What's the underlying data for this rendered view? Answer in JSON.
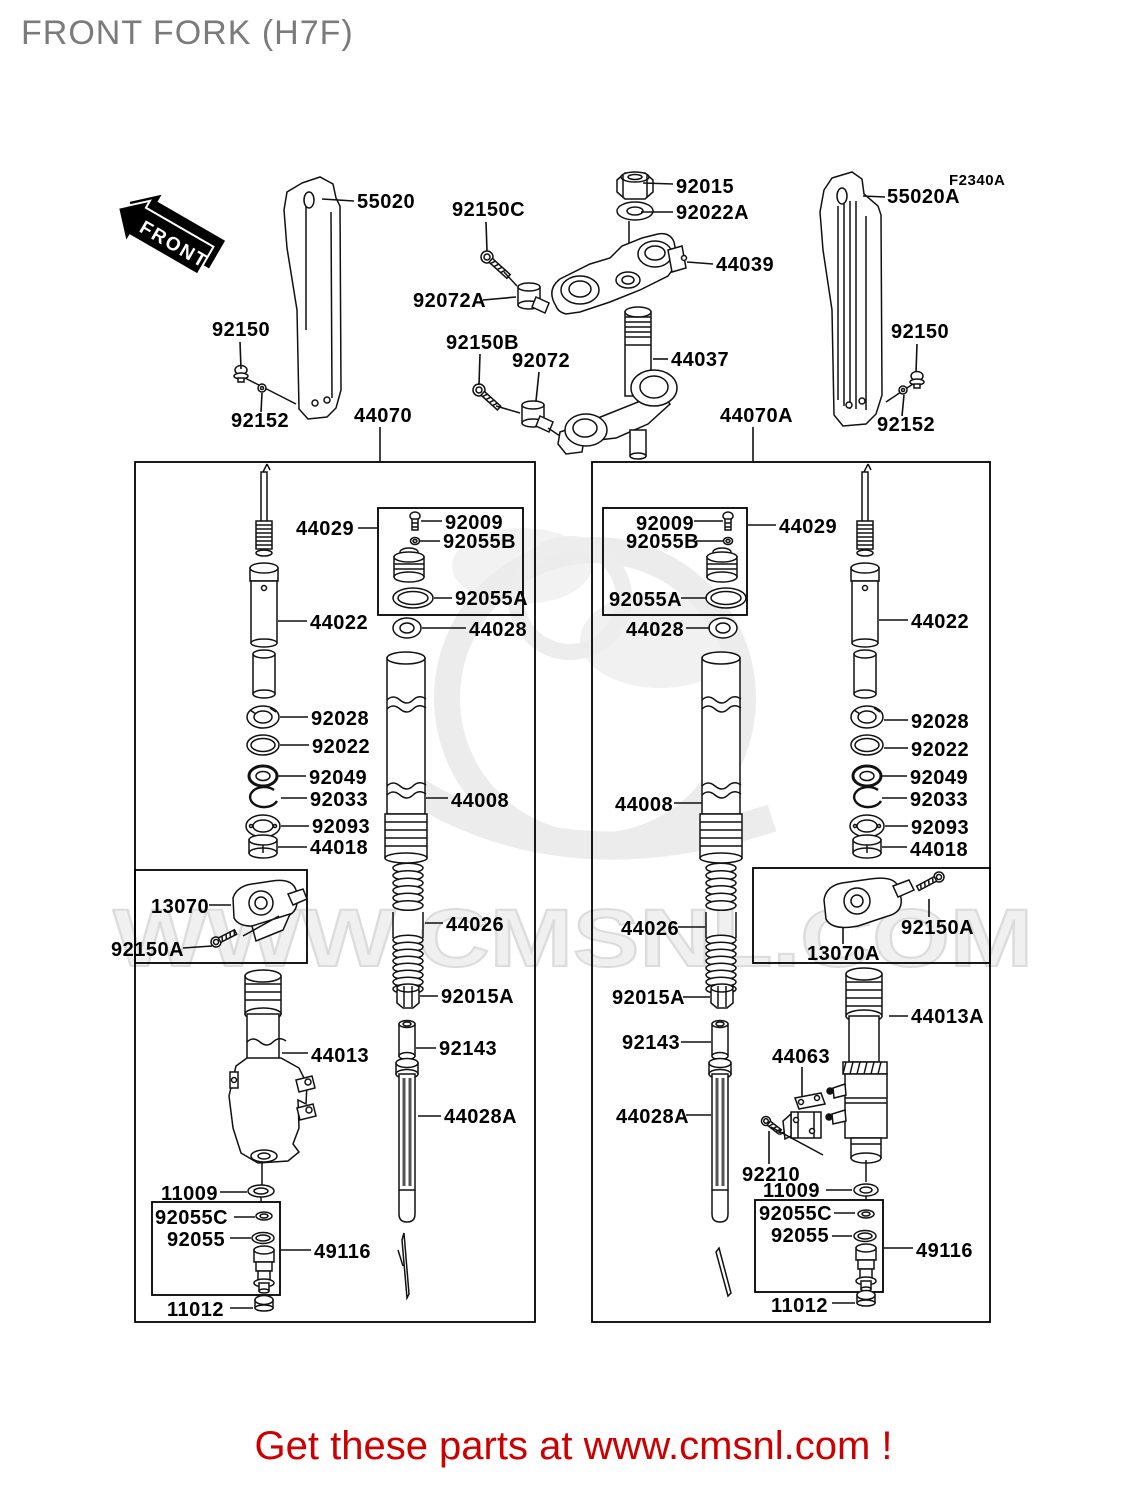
{
  "title": "FRONT FORK (H7F)",
  "diagram_code": "F2340A",
  "front_marker": "FRONT",
  "watermark": {
    "text": "WWW.CMSNL.COM"
  },
  "footer": {
    "text": "Get these parts at www.cmsnl.com !",
    "color": "#cc0000"
  },
  "colors": {
    "line": "#111111",
    "label": "#000000",
    "title": "#7b7b7b",
    "watermark": "#ececec",
    "footer": "#cc0000",
    "background": "#ffffff"
  },
  "boxes": [
    {
      "name": "left-fork-assembly",
      "x": 135,
      "y": 462,
      "w": 400,
      "h": 860
    },
    {
      "name": "right-fork-assembly",
      "x": 592,
      "y": 462,
      "w": 398,
      "h": 860
    },
    {
      "name": "left-adjuster-kit",
      "x": 378,
      "y": 508,
      "w": 145,
      "h": 107
    },
    {
      "name": "right-adjuster-kit",
      "x": 603,
      "y": 508,
      "w": 144,
      "h": 107
    },
    {
      "name": "left-clamp-kit",
      "x": 135,
      "y": 870,
      "w": 172,
      "h": 93
    },
    {
      "name": "right-clamp-kit",
      "x": 753,
      "y": 868,
      "w": 237,
      "h": 95
    },
    {
      "name": "left-valve-kit",
      "x": 152,
      "y": 1202,
      "w": 128,
      "h": 93
    },
    {
      "name": "right-valve-kit",
      "x": 755,
      "y": 1200,
      "w": 128,
      "h": 92
    }
  ],
  "labels": [
    {
      "part": "55020",
      "side": "left",
      "x": 357,
      "y": 208,
      "leader": [
        322,
        199,
        354,
        201
      ]
    },
    {
      "part": "92150C",
      "side": "top",
      "x": 452,
      "y": 216,
      "leader": [
        486,
        222,
        487,
        251
      ]
    },
    {
      "part": "92015",
      "side": "top",
      "x": 676,
      "y": 193,
      "leader": [
        643,
        183,
        673,
        184
      ]
    },
    {
      "part": "92022A",
      "side": "top",
      "x": 676,
      "y": 219,
      "leader": [
        641,
        212,
        673,
        212
      ]
    },
    {
      "part": "44039",
      "side": "top",
      "x": 716,
      "y": 271,
      "leader": [
        687,
        262,
        713,
        264
      ]
    },
    {
      "part": "92072A",
      "side": "top",
      "x": 413,
      "y": 307,
      "leader": [
        483,
        300,
        516,
        297
      ]
    },
    {
      "part": "55020A",
      "side": "right",
      "x": 887,
      "y": 203,
      "leader": [
        863,
        196,
        885,
        197
      ]
    },
    {
      "part": "F2340A",
      "side": "top",
      "x": 949,
      "y": 185,
      "size": "sm",
      "leader": null
    },
    {
      "part": "92150",
      "side": "right",
      "x": 891,
      "y": 338,
      "leader": [
        917,
        344,
        916,
        372
      ]
    },
    {
      "part": "92152",
      "side": "right",
      "x": 877,
      "y": 431,
      "leader": [
        902,
        416,
        904,
        395
      ]
    },
    {
      "part": "92150",
      "side": "left",
      "x": 212,
      "y": 336,
      "leader": [
        240,
        342,
        241,
        369
      ]
    },
    {
      "part": "92152",
      "side": "left",
      "x": 231,
      "y": 427,
      "leader": [
        261,
        412,
        262,
        393
      ]
    },
    {
      "part": "92150B",
      "side": "top",
      "x": 446,
      "y": 349,
      "leader": [
        480,
        354,
        479,
        385
      ]
    },
    {
      "part": "92072",
      "side": "top",
      "x": 512,
      "y": 367,
      "leader": [
        539,
        372,
        536,
        401
      ]
    },
    {
      "part": "44037",
      "side": "top",
      "x": 671,
      "y": 366,
      "leader": [
        653,
        359,
        668,
        359
      ]
    },
    {
      "part": "44070",
      "side": "left",
      "x": 354,
      "y": 422,
      "leader": [
        380,
        427,
        380,
        461
      ]
    },
    {
      "part": "44070A",
      "side": "right",
      "x": 720,
      "y": 422,
      "leader": [
        753,
        427,
        753,
        461
      ]
    },
    {
      "part": "44029",
      "side": "left",
      "x": 296,
      "y": 535,
      "leader": [
        358,
        528,
        377,
        528
      ]
    },
    {
      "part": "92009",
      "side": "left",
      "x": 445,
      "y": 529,
      "leader": [
        421,
        521,
        442,
        521
      ]
    },
    {
      "part": "92055B",
      "side": "left",
      "x": 443,
      "y": 548,
      "leader": [
        419,
        541,
        440,
        541
      ]
    },
    {
      "part": "92055A",
      "side": "left",
      "x": 455,
      "y": 605,
      "leader": [
        434,
        598,
        452,
        598
      ]
    },
    {
      "part": "44022",
      "side": "left",
      "x": 310,
      "y": 629,
      "leader": [
        278,
        621,
        307,
        621
      ]
    },
    {
      "part": "44028",
      "side": "left",
      "x": 469,
      "y": 636,
      "leader": [
        422,
        628,
        466,
        628
      ]
    },
    {
      "part": "92028",
      "side": "left",
      "x": 311,
      "y": 725,
      "leader": [
        280,
        717,
        308,
        717
      ]
    },
    {
      "part": "92022",
      "side": "left",
      "x": 312,
      "y": 753,
      "leader": [
        280,
        745,
        309,
        745
      ]
    },
    {
      "part": "92049",
      "side": "left",
      "x": 309,
      "y": 784,
      "leader": [
        278,
        776,
        306,
        776
      ]
    },
    {
      "part": "92033",
      "side": "left",
      "x": 310,
      "y": 806,
      "leader": [
        281,
        798,
        307,
        798
      ]
    },
    {
      "part": "92093",
      "side": "left",
      "x": 312,
      "y": 833,
      "leader": [
        281,
        826,
        309,
        826
      ]
    },
    {
      "part": "44018",
      "side": "left",
      "x": 310,
      "y": 854,
      "leader": [
        278,
        847,
        307,
        847
      ]
    },
    {
      "part": "44008",
      "side": "left",
      "x": 451,
      "y": 807,
      "leader": [
        426,
        798,
        448,
        798
      ]
    },
    {
      "part": "13070",
      "side": "left",
      "x": 151,
      "y": 913,
      "leader": [
        209,
        905,
        231,
        905
      ]
    },
    {
      "part": "92150A",
      "side": "left",
      "x": 111,
      "y": 956,
      "leader": [
        183,
        948,
        212,
        946
      ]
    },
    {
      "part": "44013",
      "side": "left",
      "x": 311,
      "y": 1062,
      "leader": [
        282,
        1053,
        308,
        1053
      ]
    },
    {
      "part": "44026",
      "side": "left",
      "x": 446,
      "y": 931,
      "leader": [
        425,
        923,
        443,
        923
      ]
    },
    {
      "part": "92015A",
      "side": "left",
      "x": 441,
      "y": 1003,
      "leader": [
        420,
        996,
        438,
        996
      ]
    },
    {
      "part": "92143",
      "side": "left",
      "x": 439,
      "y": 1055,
      "leader": [
        416,
        1048,
        436,
        1048
      ]
    },
    {
      "part": "44028A",
      "side": "left",
      "x": 444,
      "y": 1123,
      "leader": [
        418,
        1116,
        441,
        1116
      ]
    },
    {
      "part": "11009",
      "side": "left",
      "x": 161,
      "y": 1200,
      "leader": [
        220,
        1192,
        247,
        1192
      ]
    },
    {
      "part": "92055C",
      "side": "left",
      "x": 155,
      "y": 1224,
      "leader": [
        234,
        1217,
        255,
        1217
      ]
    },
    {
      "part": "92055",
      "side": "left",
      "x": 167,
      "y": 1246,
      "leader": [
        230,
        1238,
        251,
        1238
      ]
    },
    {
      "part": "49116",
      "side": "left",
      "x": 314,
      "y": 1258,
      "leader": [
        281,
        1250,
        311,
        1250
      ]
    },
    {
      "part": "11012",
      "side": "left",
      "x": 167,
      "y": 1316,
      "leader": [
        230,
        1308,
        253,
        1308
      ]
    },
    {
      "part": "44029",
      "side": "right",
      "x": 779,
      "y": 533,
      "leader": [
        748,
        525,
        776,
        525
      ]
    },
    {
      "part": "92009",
      "side": "right",
      "x": 636,
      "y": 530,
      "leader": [
        694,
        521,
        723,
        521
      ]
    },
    {
      "part": "92055B",
      "side": "right",
      "x": 626,
      "y": 548,
      "leader": [
        696,
        541,
        724,
        541
      ]
    },
    {
      "part": "92055A",
      "side": "right",
      "x": 609,
      "y": 606,
      "leader": [
        681,
        598,
        707,
        598
      ]
    },
    {
      "part": "44028",
      "side": "right",
      "x": 626,
      "y": 636,
      "leader": [
        686,
        628,
        710,
        628
      ]
    },
    {
      "part": "44022",
      "side": "right",
      "x": 911,
      "y": 628,
      "leader": [
        879,
        620,
        908,
        620
      ]
    },
    {
      "part": "44008",
      "side": "right",
      "x": 615,
      "y": 811,
      "leader": [
        674,
        803,
        702,
        803
      ]
    },
    {
      "part": "92028",
      "side": "right",
      "x": 911,
      "y": 728,
      "leader": [
        884,
        720,
        908,
        720
      ]
    },
    {
      "part": "92022",
      "side": "right",
      "x": 911,
      "y": 756,
      "leader": [
        884,
        748,
        908,
        748
      ]
    },
    {
      "part": "92049",
      "side": "right",
      "x": 910,
      "y": 784,
      "leader": [
        882,
        776,
        907,
        776
      ]
    },
    {
      "part": "92033",
      "side": "right",
      "x": 910,
      "y": 806,
      "leader": [
        882,
        798,
        907,
        798
      ]
    },
    {
      "part": "92093",
      "side": "right",
      "x": 911,
      "y": 834,
      "leader": [
        885,
        826,
        908,
        826
      ]
    },
    {
      "part": "44018",
      "side": "right",
      "x": 910,
      "y": 856,
      "leader": [
        882,
        847,
        907,
        847
      ]
    },
    {
      "part": "13070A",
      "side": "right",
      "x": 807,
      "y": 960,
      "leader": [
        843,
        928,
        843,
        944
      ]
    },
    {
      "part": "92150A",
      "side": "right",
      "x": 901,
      "y": 934,
      "leader": [
        929,
        899,
        929,
        917
      ]
    },
    {
      "part": "44026",
      "side": "right",
      "x": 621,
      "y": 935,
      "leader": [
        678,
        927,
        705,
        927
      ]
    },
    {
      "part": "92015A",
      "side": "right",
      "x": 612,
      "y": 1004,
      "leader": [
        683,
        997,
        710,
        997
      ]
    },
    {
      "part": "92143",
      "side": "right",
      "x": 622,
      "y": 1049,
      "leader": [
        681,
        1042,
        711,
        1042
      ]
    },
    {
      "part": "44063",
      "side": "right",
      "x": 772,
      "y": 1063,
      "leader": [
        802,
        1067,
        802,
        1097
      ]
    },
    {
      "part": "44028A",
      "side": "right",
      "x": 616,
      "y": 1123,
      "leader": [
        686,
        1115,
        711,
        1115
      ]
    },
    {
      "part": "44013A",
      "side": "right",
      "x": 911,
      "y": 1023,
      "leader": [
        889,
        1016,
        908,
        1016
      ]
    },
    {
      "part": "92210",
      "side": "right",
      "x": 742,
      "y": 1181,
      "leader": [
        769,
        1164,
        769,
        1131
      ]
    },
    {
      "part": "11009",
      "side": "right",
      "x": 763,
      "y": 1197,
      "leader": [
        826,
        1190,
        852,
        1190
      ]
    },
    {
      "part": "92055C",
      "side": "right",
      "x": 759,
      "y": 1220,
      "leader": [
        834,
        1213,
        855,
        1213
      ]
    },
    {
      "part": "92055",
      "side": "right",
      "x": 771,
      "y": 1242,
      "leader": [
        832,
        1236,
        852,
        1236
      ]
    },
    {
      "part": "49116",
      "side": "right",
      "x": 916,
      "y": 1257,
      "leader": [
        884,
        1248,
        913,
        1248
      ]
    },
    {
      "part": "11012",
      "side": "right",
      "x": 771,
      "y": 1312,
      "leader": [
        832,
        1303,
        855,
        1303
      ]
    }
  ]
}
